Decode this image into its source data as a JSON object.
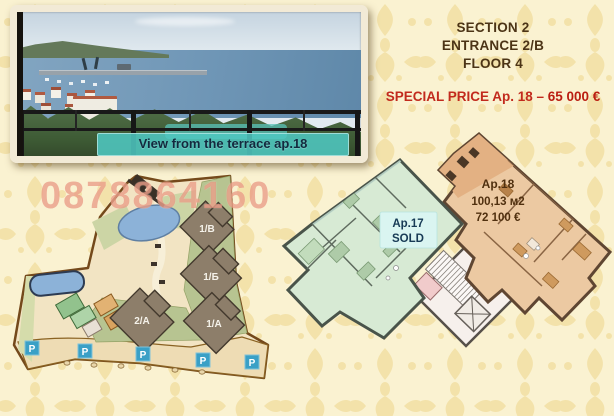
{
  "header": {
    "line1": "SECTION 2",
    "line2": "ENTRANCE 2/B",
    "line3": "FLOOR 4",
    "special_price": "SPECIAL PRICE Ap. 18 –",
    "price_value": "65 000 €"
  },
  "photo": {
    "caption": "View from the terrace ap.18"
  },
  "watermark": {
    "phone": "0878864160"
  },
  "site_plan": {
    "buildings": [
      {
        "label": "1/B"
      },
      {
        "label": "1/Б"
      },
      {
        "label": "2/A"
      },
      {
        "label": "1/A"
      }
    ],
    "parking_label": "P"
  },
  "floor_plan": {
    "ap17": {
      "name": "Ap.17",
      "status": "SOLD"
    },
    "ap18": {
      "name": "Ap.18",
      "area": "100,13 м2",
      "price": "72 100 €"
    }
  },
  "colors": {
    "accent_red": "#c22a1d",
    "header_brown": "#4c3416",
    "watermark_salmon": "#de745a",
    "parking_blue": "#3aa0c6",
    "pool_blue": "#8cb2d8",
    "ap17_green": "#d7ead4",
    "ap18_orange": "#ecc9a2",
    "background_cream": "#faf2d1"
  }
}
